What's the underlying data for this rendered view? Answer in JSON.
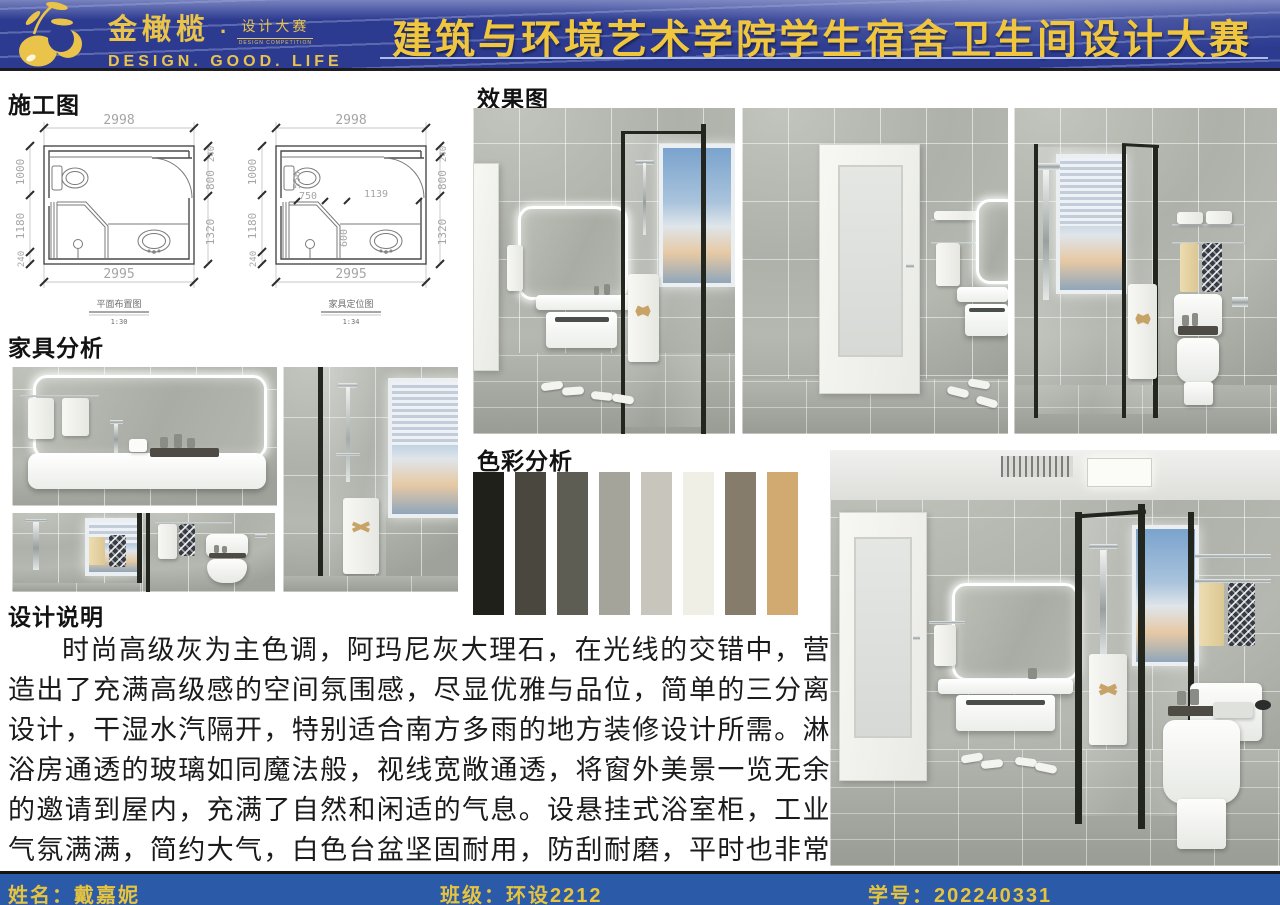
{
  "banner": {
    "brand": "金橄榄",
    "brand_dot": "·",
    "brand_sub": "设计大赛",
    "brand_sub_en": "DESIGN COMPETITION",
    "tagline": "DESIGN.  GOOD.  LIFE",
    "title": "建筑与环境艺术学院学生宿舍卫生间设计大赛"
  },
  "sections": {
    "construction_label": "施工图",
    "rendering_label": "效果图",
    "furniture_label": "家具分析",
    "palette_label": "色彩分析",
    "description_label": "设计说明"
  },
  "plans": [
    {
      "caption": "平面布置图",
      "scale": "1:30",
      "dims": {
        "top": "2998",
        "bottom": "2995",
        "left": [
          "1000",
          "1180",
          "240"
        ],
        "right": [
          "240",
          "800",
          "1320"
        ]
      }
    },
    {
      "caption": "家具定位图",
      "scale": "1:34",
      "dims": {
        "top": "2998",
        "bottom": "2995",
        "left": [
          "1000",
          "1180",
          "240"
        ],
        "right": [
          "240",
          "800",
          "1320"
        ],
        "inner": {
          "toilet_width": "550",
          "left_span": "750",
          "right_span": "1139",
          "shower_depth": "600"
        }
      }
    }
  ],
  "palette": {
    "swatches": [
      "#20201a",
      "#4a473f",
      "#5d5d53",
      "#a5a49b",
      "#c8c5bc",
      "#f0efe6",
      "#857c6b",
      "#d0aa70"
    ]
  },
  "description": "时尚高级灰为主色调，阿玛尼灰大理石，在光线的交错中，营造出了充满高级感的空间氛围感，尽显优雅与品位，简单的三分离设计，干湿水汽隔开，特别适合南方多雨的地方装修设计所需。淋浴房通透的玻璃如同魔法般，视线宽敞通透，将窗外美景一览无余的邀请到屋内，充满了自然和闲适的气息。设悬挂式浴室柜，工业气氛满满，简约大气，白色台盆坚固耐用，防刮耐磨，平时也非常好打理简约而高雅的氛围，在这个舒适的空间里，心情不禁愉悦舒畅。",
  "footer": {
    "name_label": "姓名：",
    "name_value": "戴嘉妮",
    "class_label": "班级：",
    "class_value": "环设2212",
    "id_label": "学号：",
    "id_value": "202240331"
  },
  "theme": {
    "banner_blue": "#2c3a90",
    "gold": "#f0c63e",
    "footer_blue": "#2a5aa8",
    "page_bg": "#ffffff",
    "tile_gray": "#afb2aa"
  }
}
